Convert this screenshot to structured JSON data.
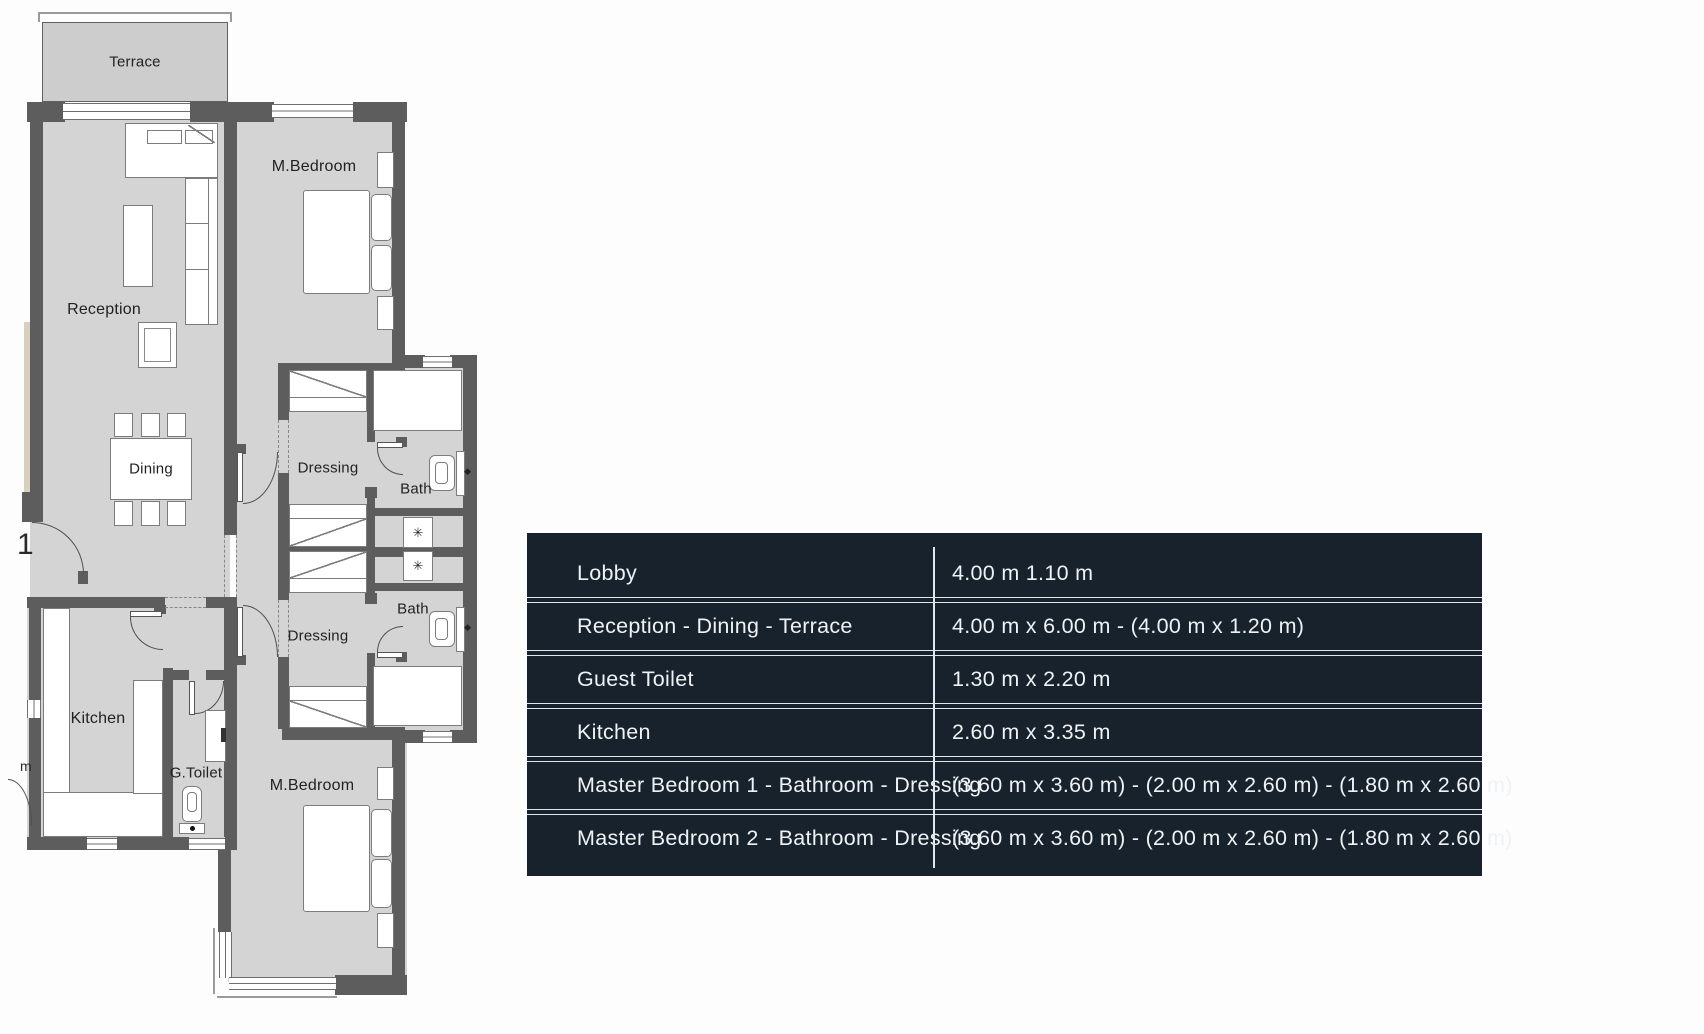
{
  "plan": {
    "labels": {
      "terrace": "Terrace",
      "master_bedroom_top": "M.Bedroom",
      "reception": "Reception",
      "dining": "Dining",
      "dressing_top": "Dressing",
      "bath_top": "Bath",
      "dressing_bottom": "Dressing",
      "bath_bottom": "Bath",
      "kitchen": "Kitchen",
      "guest_toilet": "G.Toilet",
      "master_bedroom_bottom": "M.Bedroom"
    },
    "edge_fragments": {
      "digit": "1",
      "letter": "m"
    },
    "shower_glyph": "✳",
    "toilet_arrow_glyph": "◆"
  },
  "dimensions_table": {
    "rows": [
      {
        "label": "Lobby",
        "value": "4.00 m 1.10 m"
      },
      {
        "label": "Reception - Dining - Terrace",
        "value": "4.00 m x 6.00 m - (4.00 m x 1.20 m)"
      },
      {
        "label": "Guest Toilet",
        "value": "1.30 m x 2.20 m"
      },
      {
        "label": "Kitchen",
        "value": "2.60 m x 3.35 m"
      },
      {
        "label": "Master Bedroom 1 - Bathroom - Dressing",
        "value": "(3.60 m x 3.60 m) - (2.00 m x 2.60 m) - (1.80 m x 2.60 m)"
      },
      {
        "label": "Master Bedroom 2 - Bathroom - Dressing",
        "value": "(3.60 m x 3.60 m) - (2.00 m x 2.60 m) - (1.80 m x 2.60 m)"
      }
    ],
    "style": {
      "background": "#18222c",
      "text_color": "#eef2f5",
      "line_color": "#dfe7ec"
    }
  }
}
